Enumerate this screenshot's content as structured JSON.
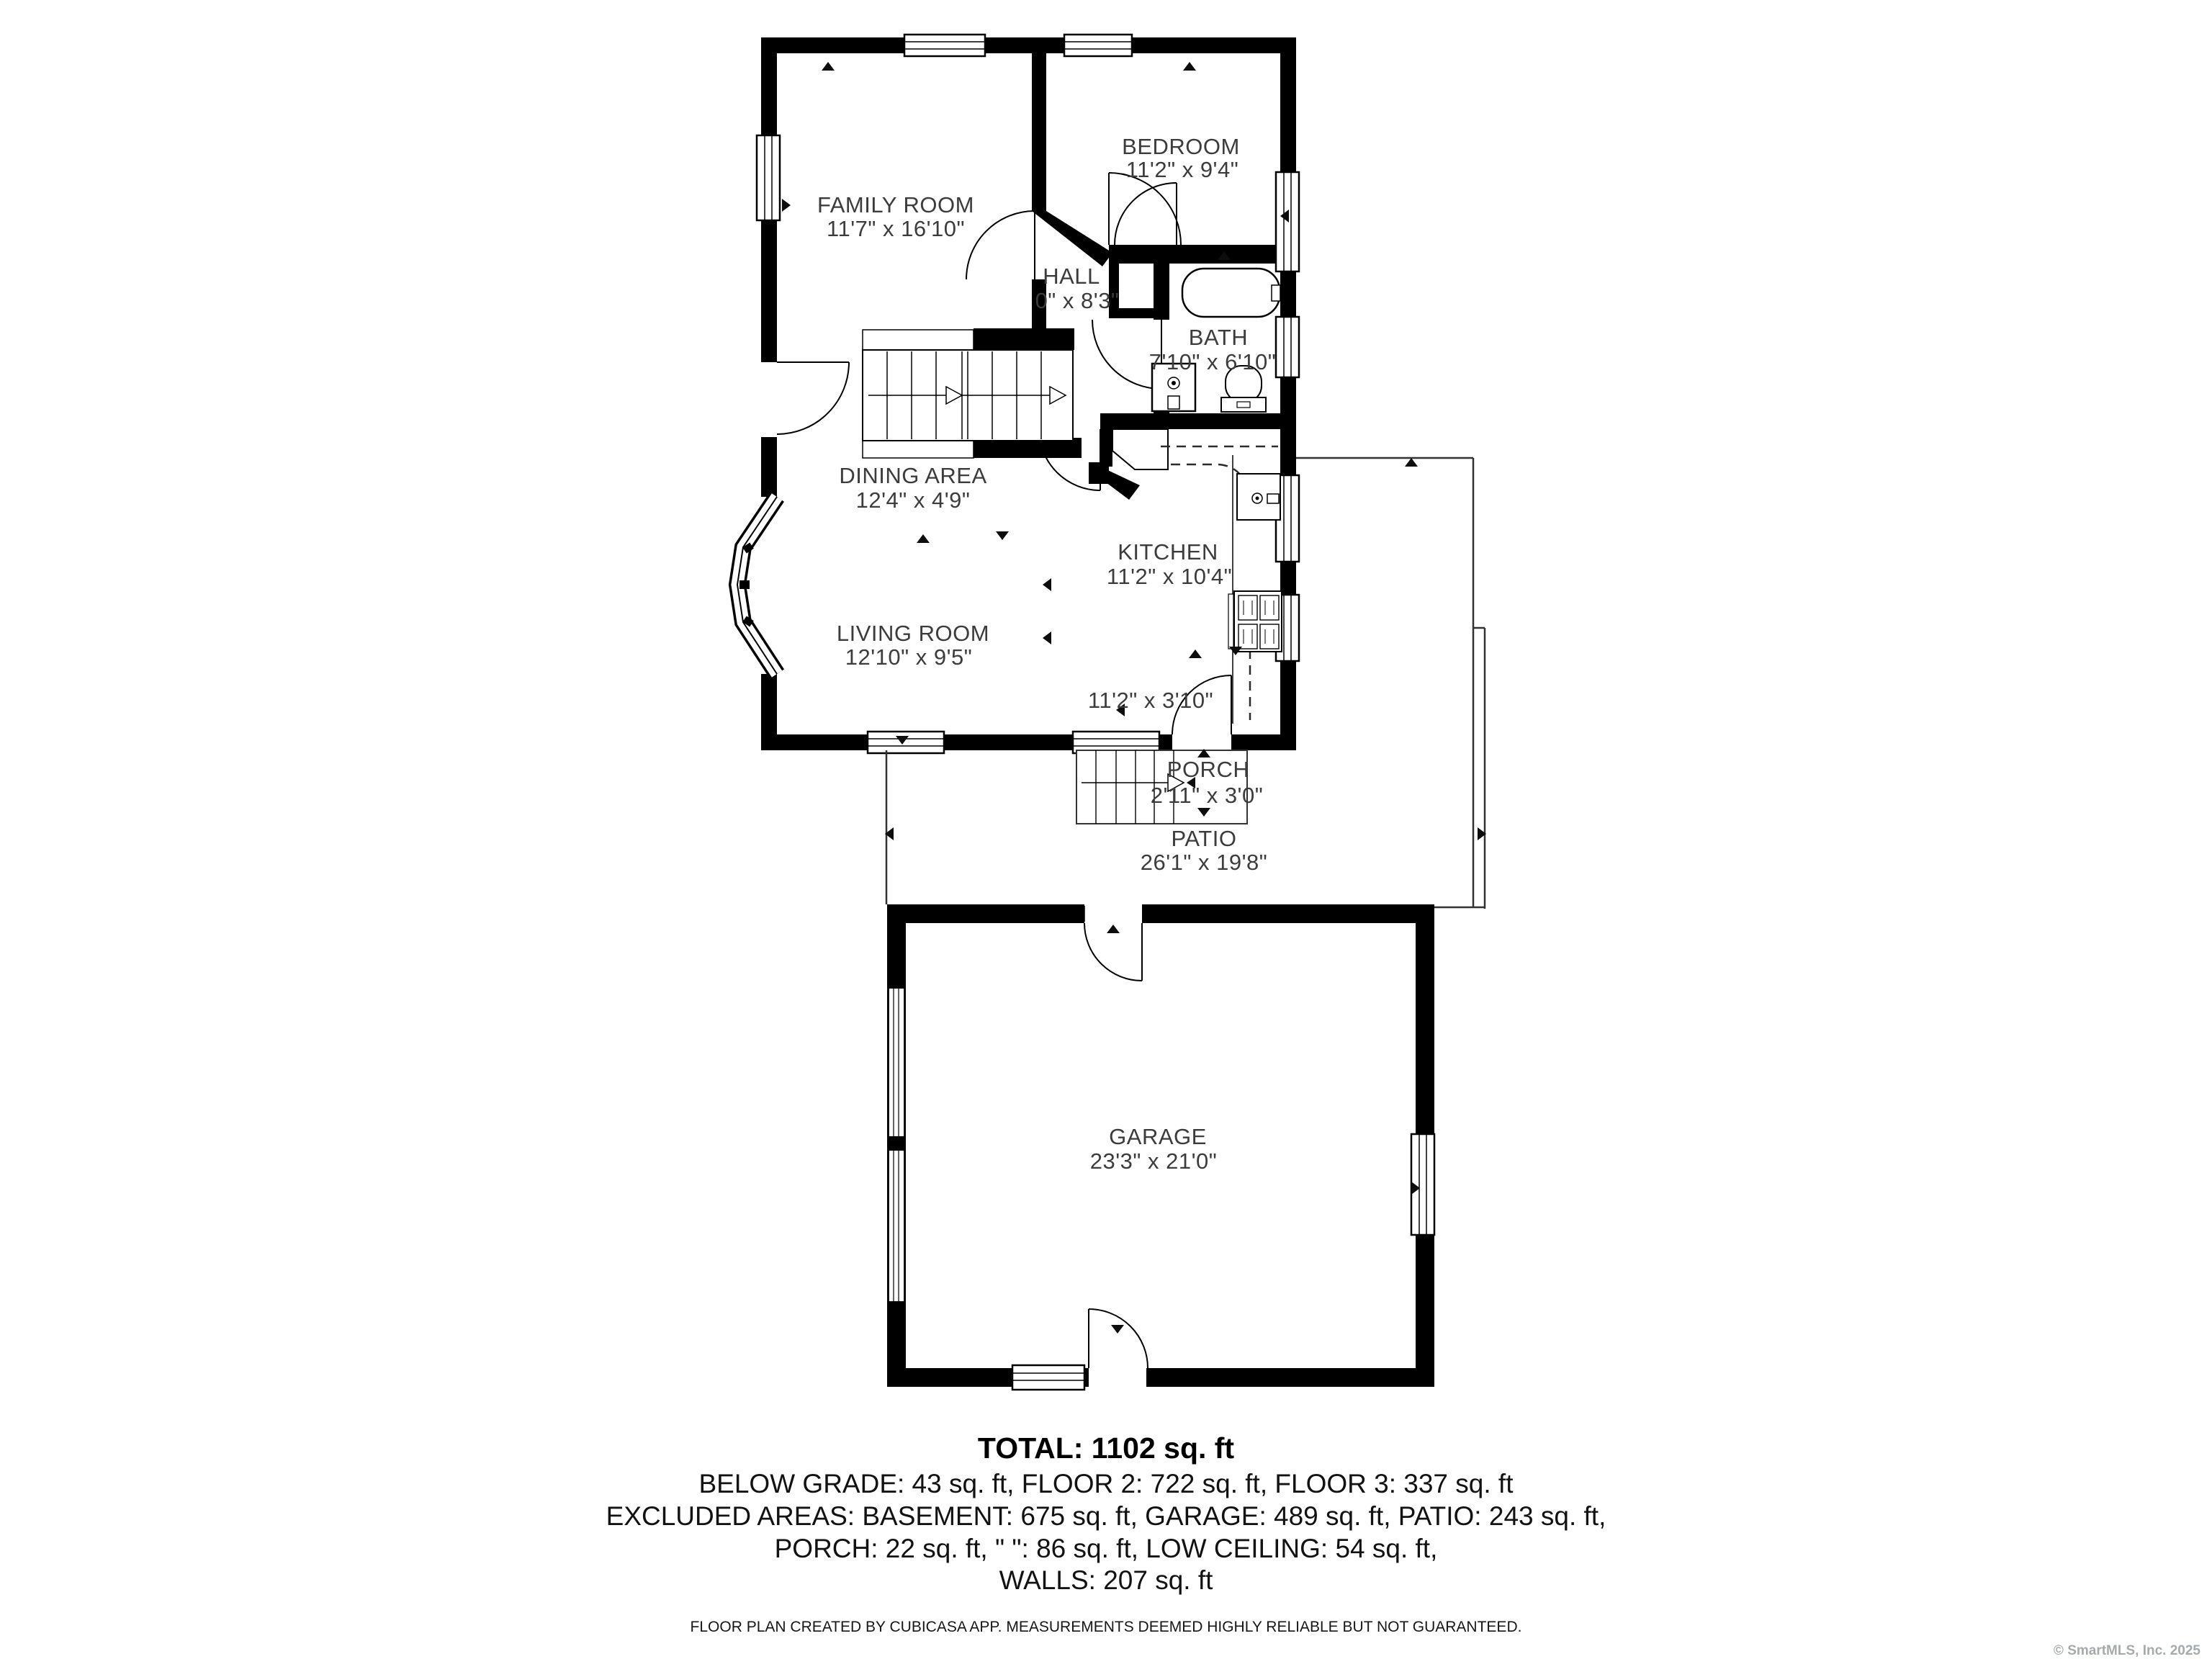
{
  "rooms": {
    "family_room": {
      "name": "FAMILY ROOM",
      "dims": "11'7\" x 16'10\""
    },
    "bedroom": {
      "name": "BEDROOM",
      "dims": "11'2\" x 9'4\""
    },
    "hall": {
      "name": "HALL",
      "dims": "0\" x 8'3\""
    },
    "bath": {
      "name": "BATH",
      "dims": "7'10\" x 6'10\""
    },
    "dining_area": {
      "name": "DINING AREA",
      "dims": "12'4\" x 4'9\""
    },
    "kitchen": {
      "name": "KITCHEN",
      "dims": "11'2\" x 10'4\""
    },
    "living_room": {
      "name": "LIVING ROOM",
      "dims": "12'10\" x 9'5\""
    },
    "nook": {
      "dims": "11'2\" x 3'10\""
    },
    "porch": {
      "name": "PORCH",
      "dims": "2'11\" x 3'0\""
    },
    "patio": {
      "name": "PATIO",
      "dims": "26'1\" x 19'8\""
    },
    "garage": {
      "name": "GARAGE",
      "dims": "23'3\" x 21'0\""
    }
  },
  "summary": {
    "total": "TOTAL: 1102 sq. ft",
    "line1": "BELOW GRADE: 43 sq. ft, FLOOR 2: 722 sq. ft, FLOOR 3: 337 sq. ft",
    "line2": "EXCLUDED AREAS: BASEMENT: 675 sq. ft, GARAGE: 489 sq. ft, PATIO: 243 sq. ft,",
    "line3": "PORCH: 22 sq. ft, \" \": 86 sq. ft, LOW CEILING: 54 sq. ft,",
    "line4": "WALLS: 207 sq. ft"
  },
  "footer": {
    "disclaimer": "FLOOR PLAN CREATED BY CUBICASA APP. MEASUREMENTS DEEMED HIGHLY RELIABLE BUT NOT GUARANTEED."
  },
  "watermark": "© SmartMLS, Inc. 2025",
  "colors": {
    "wall": "#000000",
    "label": "#3c3c3c",
    "watermark": "#a6aaad",
    "background": "#ffffff"
  }
}
